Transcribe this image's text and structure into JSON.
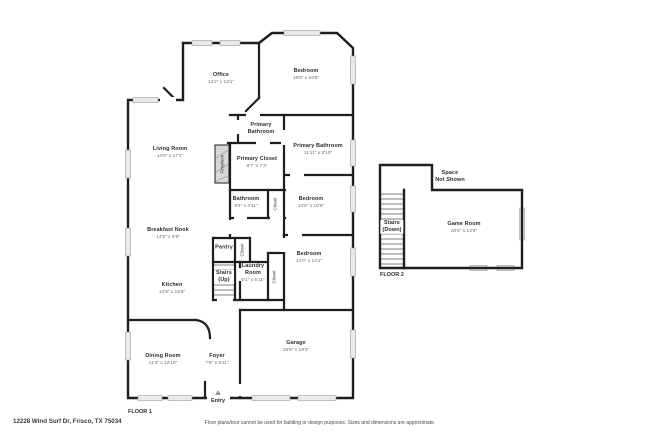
{
  "floor1": {
    "tag": "FLOOR 1",
    "entry": {
      "label": "Entry"
    },
    "rooms": {
      "office": {
        "name": "Office",
        "dims": "13'2\" x 13'1\""
      },
      "bedroom_top": {
        "name": "Bedroom",
        "dims": "18'6\" x 16'6\""
      },
      "living_room": {
        "name": "Living Room",
        "dims": "14'9\" x 17'1\""
      },
      "primary_bathroom_hall": {
        "name": "Primary\nBathroom"
      },
      "primary_closet": {
        "name": "Primary Closet",
        "dims": "8'7\" x 7'3\""
      },
      "primary_bathroom": {
        "name": "Primary Bathroom",
        "dims": "11'11\" x 8'10\""
      },
      "fireplace": {
        "name": "Fireplace"
      },
      "bathroom": {
        "name": "Bathroom",
        "dims": "8'4\" x 4'11\""
      },
      "closet_bath": {
        "name": "Closet"
      },
      "bedroom_mid": {
        "name": "Bedroom",
        "dims": "14'5\" x 10'5\""
      },
      "breakfast_nook": {
        "name": "Breakfast Nook",
        "dims": "14'9\" x 9'9\""
      },
      "pantry": {
        "name": "Pantry"
      },
      "closet_pantry": {
        "name": "Closet"
      },
      "stairs_up": {
        "name": "Stairs\n(Up)"
      },
      "laundry_room": {
        "name": "Laundry\nRoom",
        "dims": "5'1\" x 5'11\""
      },
      "closet_hall": {
        "name": "Closet"
      },
      "bedroom_lower": {
        "name": "Bedroom",
        "dims": "14'0\" x 14'1\""
      },
      "kitchen": {
        "name": "Kitchen",
        "dims": "14'9\" x 15'6\""
      },
      "dining_room": {
        "name": "Dining Room",
        "dims": "11'3\" x 12'10\""
      },
      "foyer": {
        "name": "Foyer",
        "dims": "7'6\" x 9'11\""
      },
      "garage": {
        "name": "Garage",
        "dims": "18'6\" x 19'4\""
      }
    }
  },
  "floor2": {
    "tag": "FLOOR 2",
    "rooms": {
      "space_not_shown": {
        "name": "Space\nNot Shown"
      },
      "stairs_down": {
        "name": "Stairs\n(Down)"
      },
      "game_room": {
        "name": "Game Room",
        "dims": "20'5\" x 13'9\""
      }
    }
  },
  "footer": {
    "address": "12228 Wind Surf Dr, Frisco, TX 75034",
    "disclaimer": "Floor plans/tour cannot be used for building or design purposes. Sizes and dimensions are approximate."
  },
  "colors": {
    "wall": "#1e1e1e",
    "window_fill": "#e9e9e9",
    "window_border": "#9b9b9b",
    "room_name": "#2e2e2e",
    "room_dims": "#6e6e6e",
    "fireplace_fill": "#d8d8d8"
  }
}
